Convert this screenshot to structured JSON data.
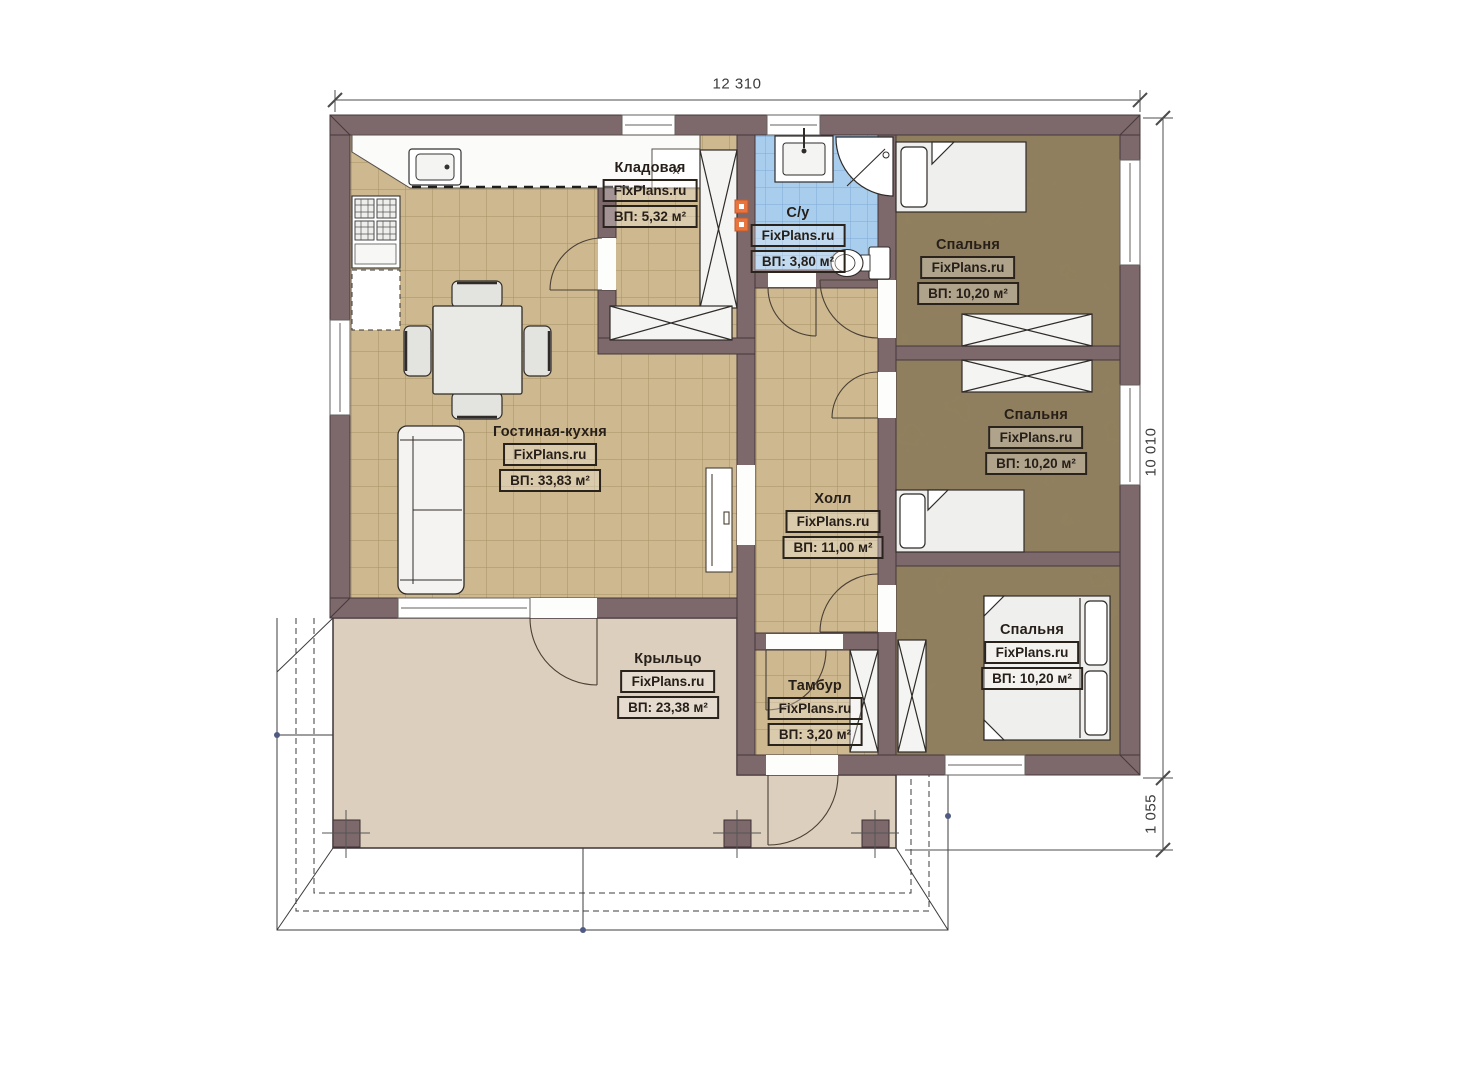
{
  "plan": {
    "watermark": "FixPlans.ru",
    "dimensions": {
      "top": "12 310",
      "right": "10 010",
      "right_lower": "1 055"
    },
    "markers": {
      "kitchen_x": "x"
    },
    "rooms": [
      {
        "key": "kladovaya",
        "name": "Кладовая",
        "area": "ВП: 5,32 м²"
      },
      {
        "key": "su",
        "name": "С/у",
        "area": "ВП: 3,80 м²"
      },
      {
        "key": "bedroom-top",
        "name": "Спальня",
        "area": "ВП: 10,20 м²"
      },
      {
        "key": "bedroom-middle",
        "name": "Спальня",
        "area": "ВП: 10,20 м²"
      },
      {
        "key": "bedroom-bottom",
        "name": "Спальня",
        "area": "ВП: 10,20 м²"
      },
      {
        "key": "living-kitchen",
        "name": "Гостиная-кухня",
        "area": "ВП: 33,83 м²"
      },
      {
        "key": "hall",
        "name": "Холл",
        "area": "ВП: 11,00 м²"
      },
      {
        "key": "tambur",
        "name": "Тамбур",
        "area": "ВП: 3,20 м²"
      },
      {
        "key": "porch",
        "name": "Крыльцо",
        "area": "ВП: 23,38 м²"
      }
    ],
    "colors": {
      "wall": "#7d686b",
      "wall_outline": "#45383b",
      "floor_tile_tan": "#cdb88f",
      "floor_bedroom": "#8d7b59",
      "floor_bath": "#a9cdec",
      "floor_porch": "#dccfbd",
      "vent_orange": "#e8743f",
      "label_text": "#261f19"
    }
  }
}
